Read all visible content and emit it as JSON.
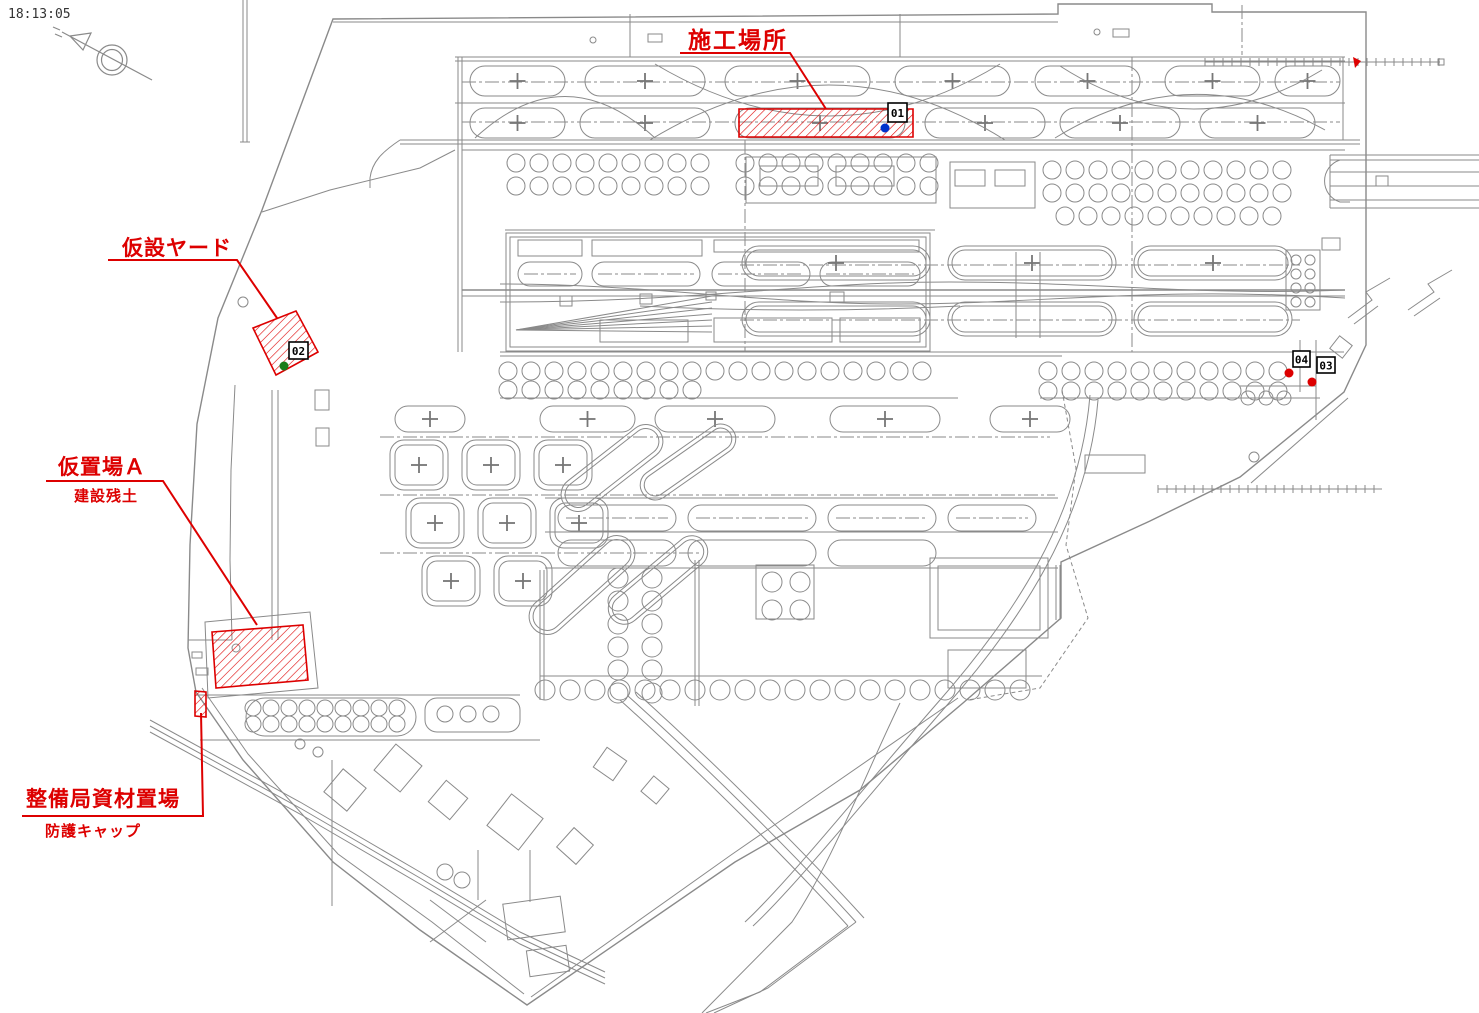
{
  "page": {
    "timestamp": "18:13:05"
  },
  "colors": {
    "annotation_red": "#dd0000",
    "drawing_grey": "#8a8a8a",
    "dot_blue": "#0033cc",
    "dot_green": "#1a7d1a",
    "dot_red": "#dd0000",
    "marker_box_bg": "#ffffff",
    "marker_box_border": "#000000"
  },
  "annotations": {
    "construction_site": {
      "label": "施工場所"
    },
    "temporary_yard": {
      "label": "仮設ヤード"
    },
    "staging_area_a": {
      "label": "仮置場Ａ",
      "sublabel": "建設残土"
    },
    "maintenance_materials": {
      "label": "整備局資材置場",
      "sublabel": "防護キャップ"
    }
  },
  "markers": {
    "m01": {
      "id": "01",
      "dot": "blue"
    },
    "m02": {
      "id": "02",
      "dot": "green"
    },
    "m03": {
      "id": "03",
      "dot": "red"
    },
    "m04": {
      "id": "04",
      "dot": "red"
    }
  }
}
